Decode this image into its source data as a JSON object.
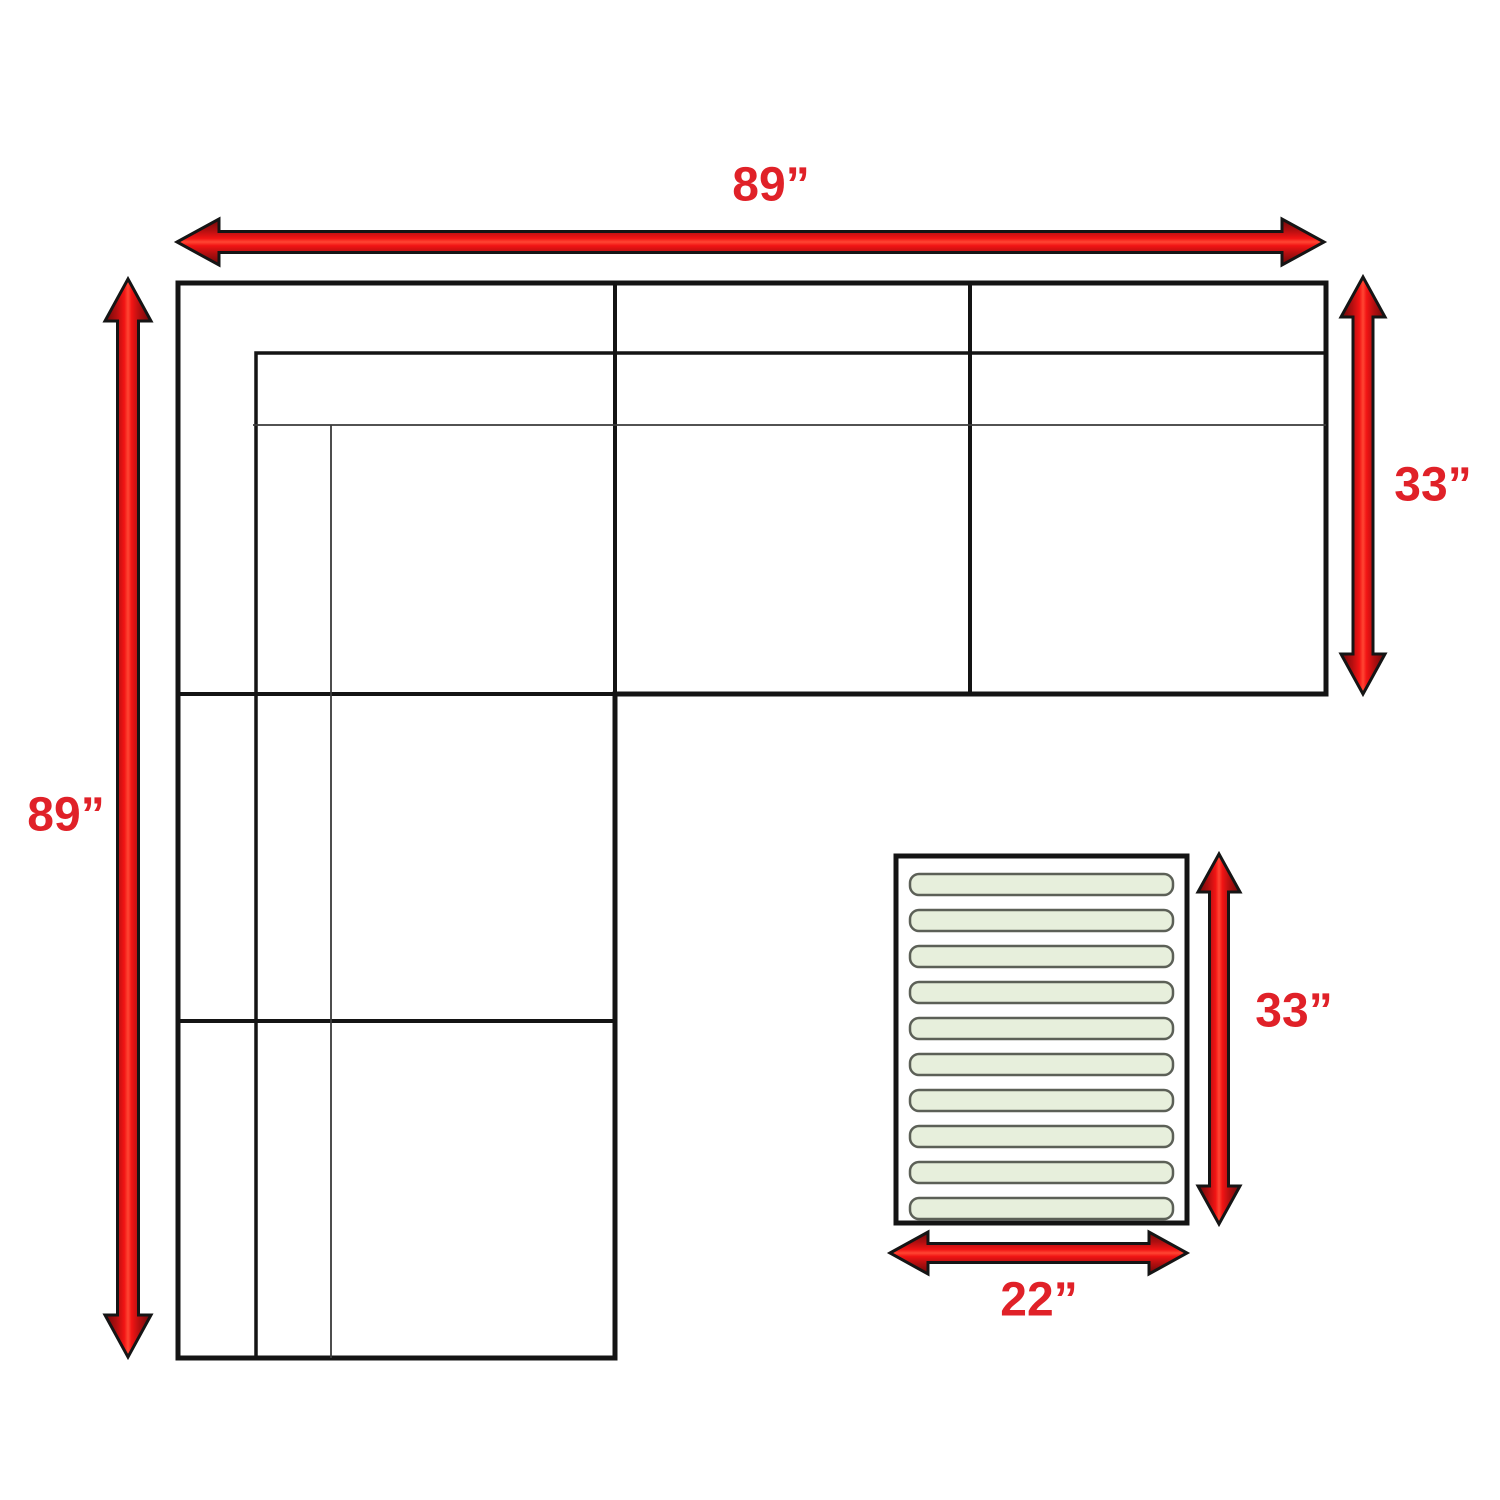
{
  "diagram": {
    "title": "Sectional sofa with ottoman dimension diagram",
    "measurements": {
      "sofa_width": "89”",
      "sofa_length": "89”",
      "sofa_depth": "33”",
      "ottoman_length": "33”",
      "ottoman_width": "22”"
    },
    "ottoman": {
      "slat_count": 10
    },
    "colors": {
      "background": "#ffffff",
      "line_black": "#141414",
      "line_thin": "#3a3a3a",
      "label_red": "#e02128",
      "arrow_red": "#f21414",
      "arrow_red_mid": "#b30f10",
      "arrow_red_dark": "#6d0809",
      "arrow_red_highlight": "#ff4633",
      "arrow_outline": "#151515",
      "slat_fill": "#e7efdc",
      "slat_border": "#5c6057"
    }
  }
}
